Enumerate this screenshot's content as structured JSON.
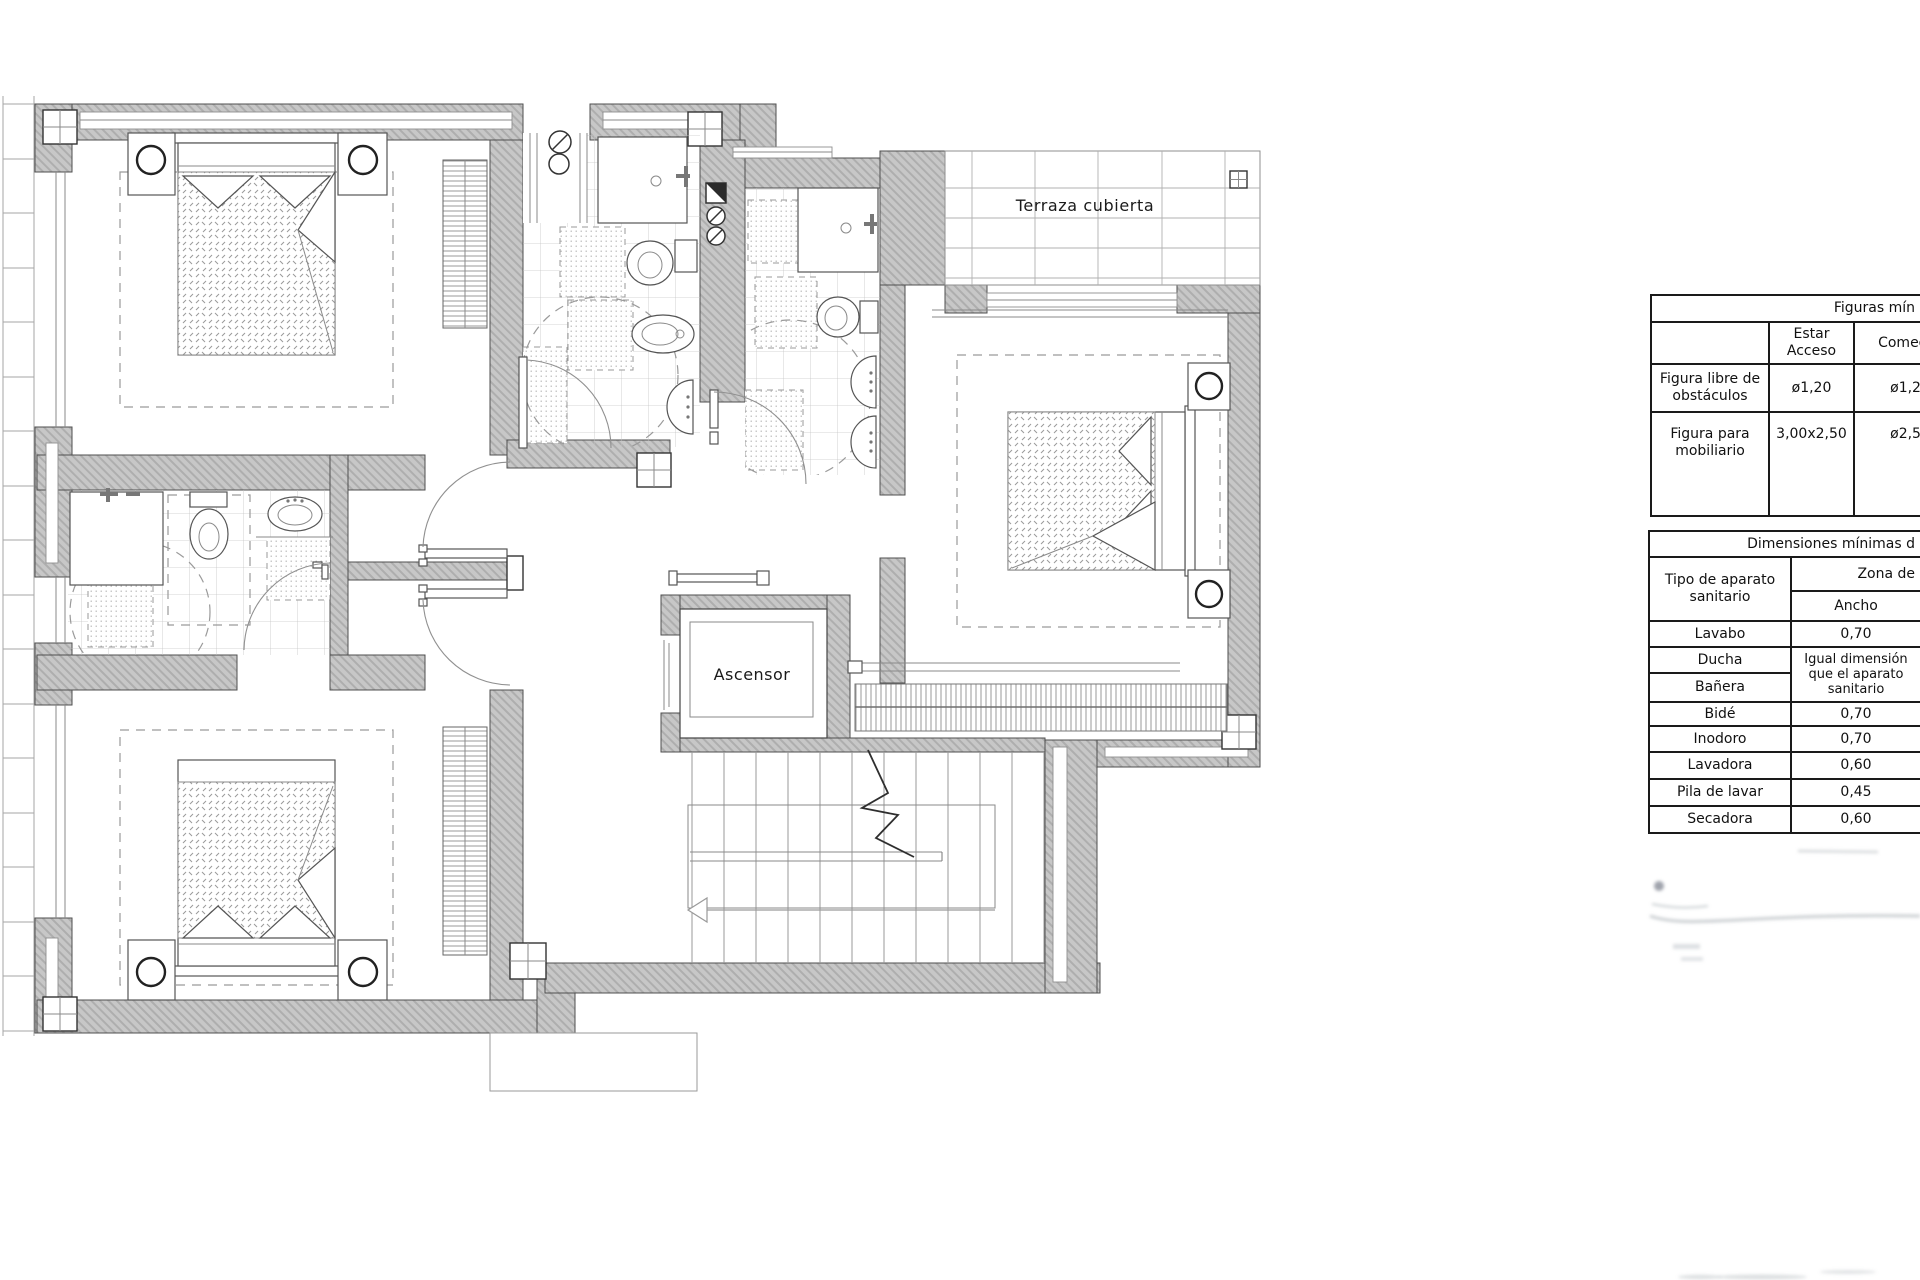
{
  "plan": {
    "labels": {
      "terrace": "Terraza cubierta",
      "elevator": "Ascensor"
    },
    "colors": {
      "wall_gray": "#c7c7c7",
      "line_dark": "#4f4f4f",
      "line_light": "#9a9a9a"
    }
  },
  "figures_table": {
    "title": "Figuras mín",
    "col_estar": "Estar Acceso",
    "col_comedor": "Comedor",
    "rows": [
      {
        "label": "Figura libre de obstáculos",
        "estar": "ø1,20",
        "comedor": "ø1,20"
      },
      {
        "label": "Figura para mobiliario",
        "estar": "3,00x2,50",
        "comedor": "ø2,50"
      }
    ]
  },
  "dimensions_table": {
    "title": "Dimensiones mínimas d",
    "type_header": "Tipo de aparato sanitario",
    "zone_header": "Zona de",
    "width_header": "Ancho",
    "shared_value": "Igual dimensión que el aparato sanitario",
    "rows": [
      {
        "label": "Lavabo",
        "value": "0,70"
      },
      {
        "label": "Ducha",
        "value": ""
      },
      {
        "label": "Bañera",
        "value": ""
      },
      {
        "label": "Bidé",
        "value": "0,70"
      },
      {
        "label": "Inodoro",
        "value": "0,70"
      },
      {
        "label": "Lavadora",
        "value": "0,60"
      },
      {
        "label": "Pila de lavar",
        "value": "0,45"
      },
      {
        "label": "Secadora",
        "value": "0,60"
      }
    ]
  }
}
